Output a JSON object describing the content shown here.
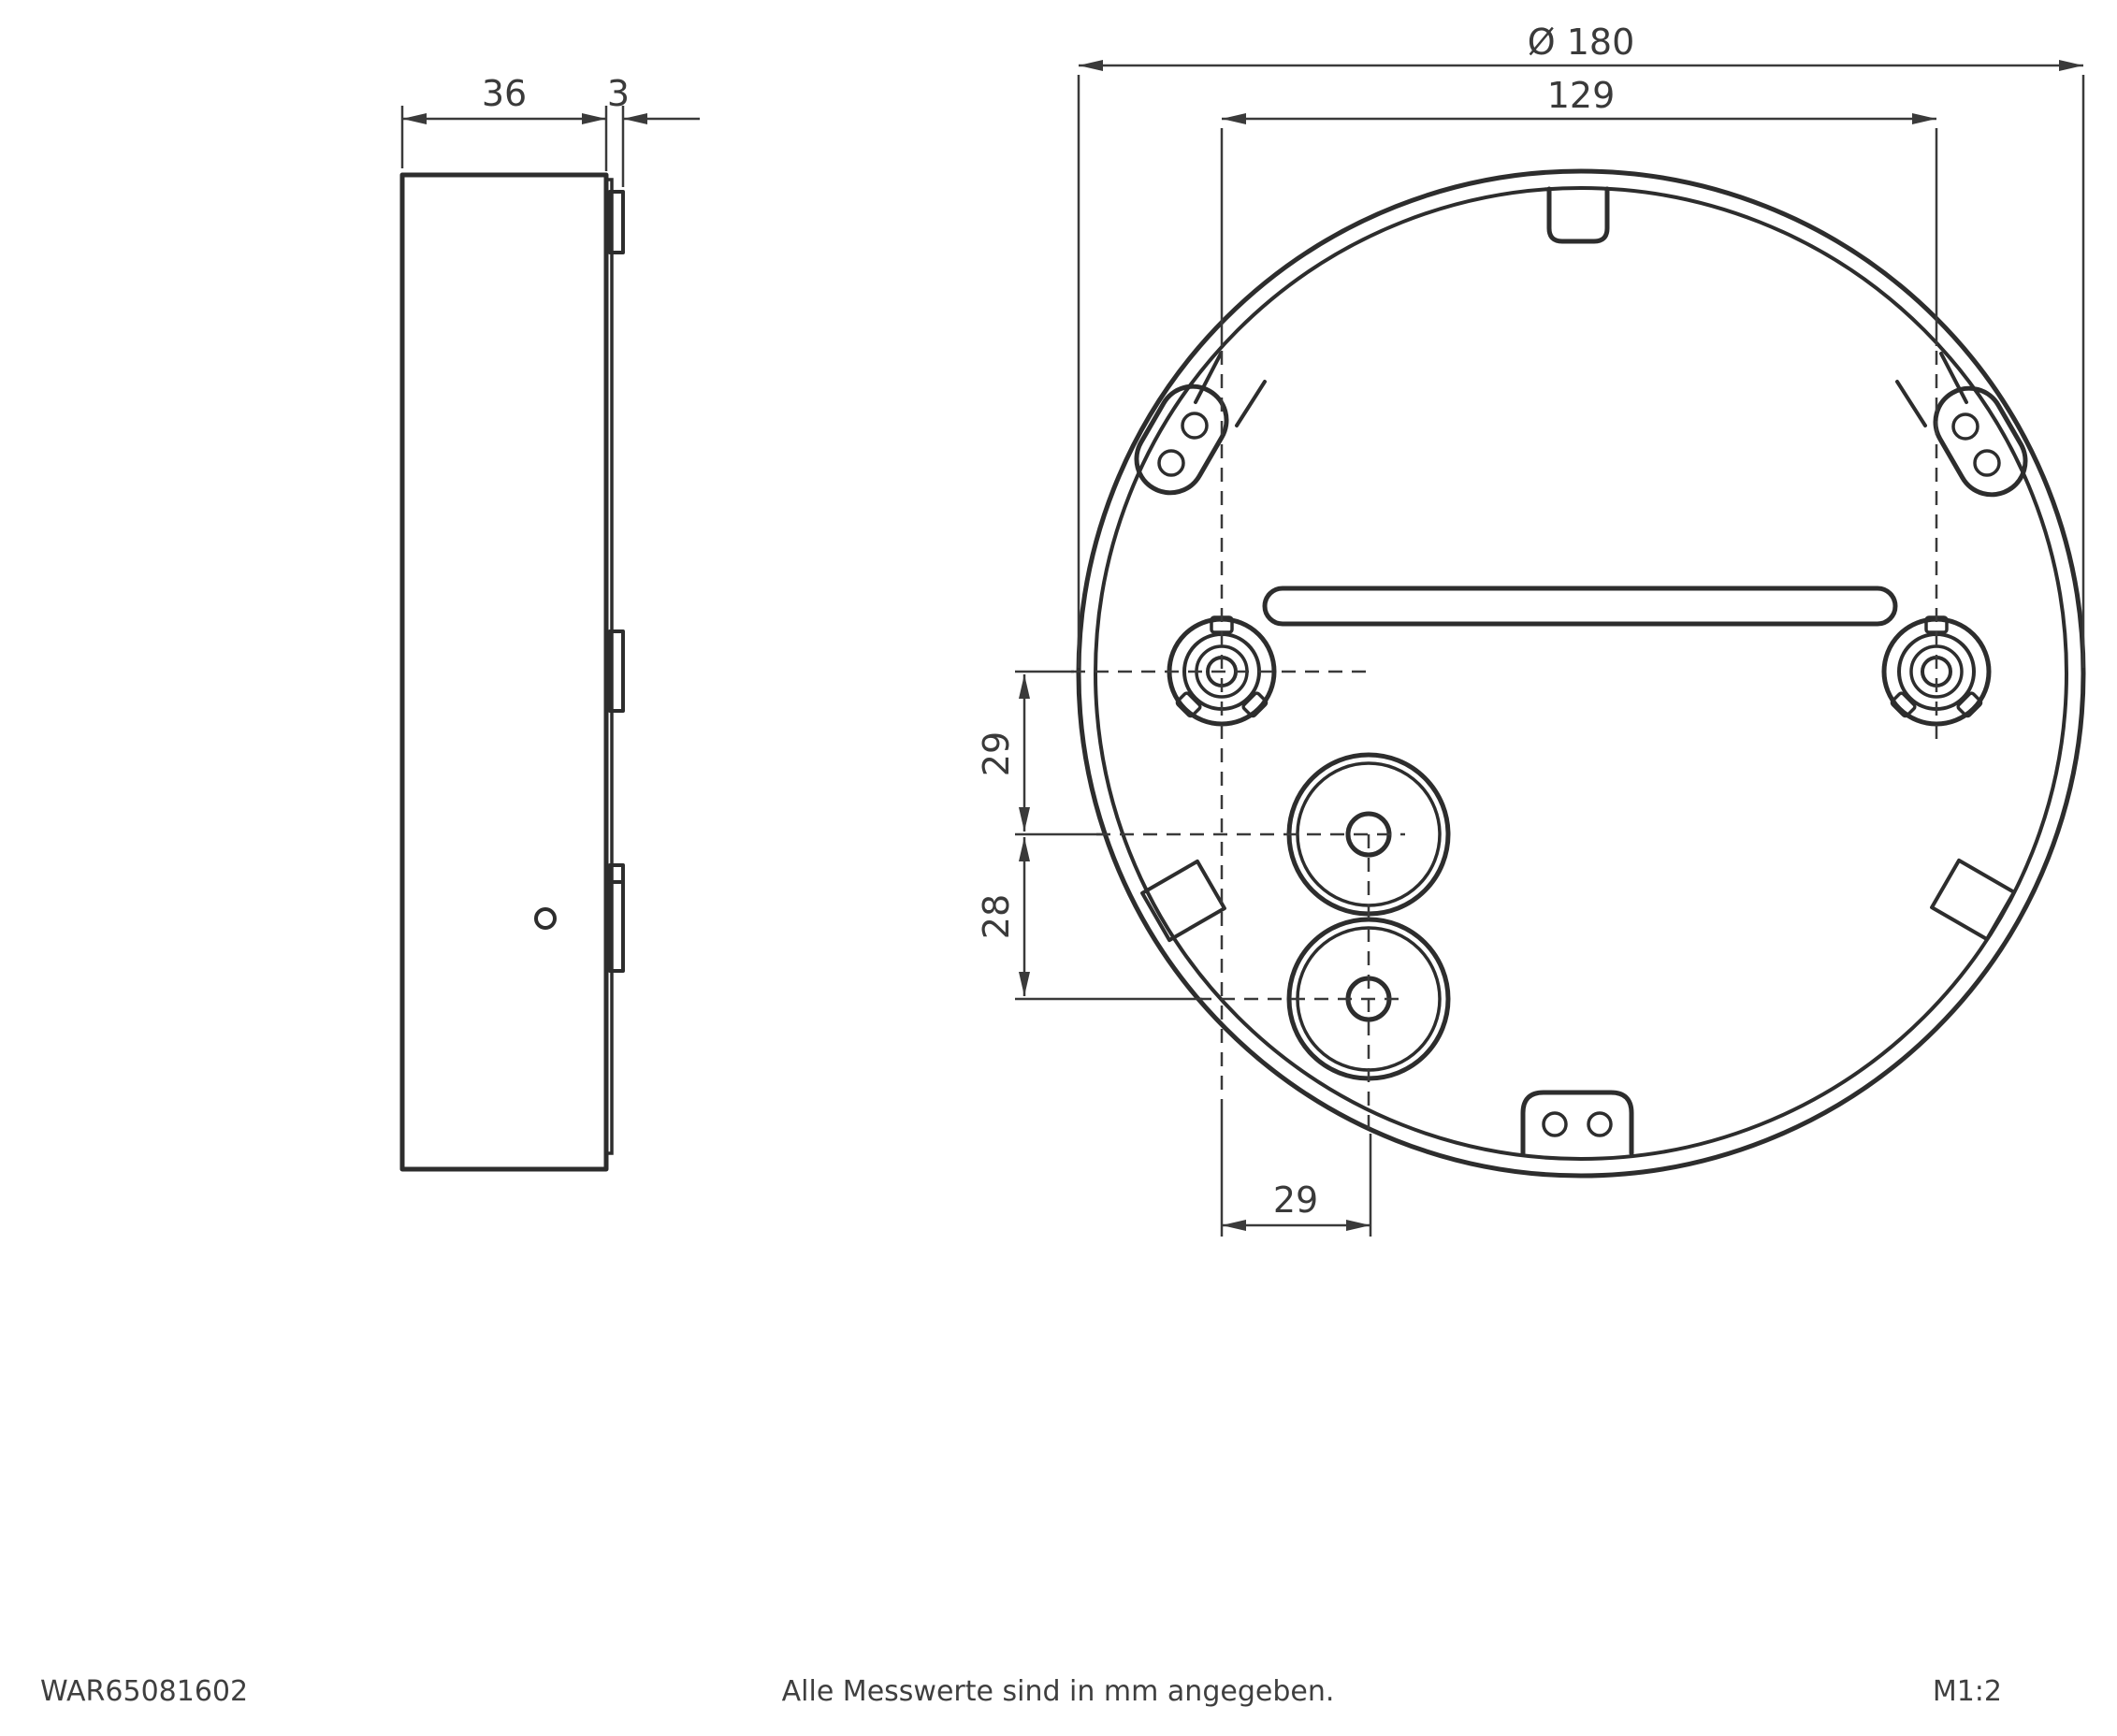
{
  "drawing": {
    "part_number": "WAR65081602",
    "footer_note": "Alle Messwerte sind in mm angegeben.",
    "scale_label": "M1:2",
    "line_color": "#2d2d2d",
    "dims": {
      "side_width": "36",
      "plate_thickness": "3",
      "diameter": "Ø 180",
      "screw_spacing": "129",
      "offset_top": "29",
      "offset_mid": "28",
      "offset_horizontal": "29"
    }
  }
}
